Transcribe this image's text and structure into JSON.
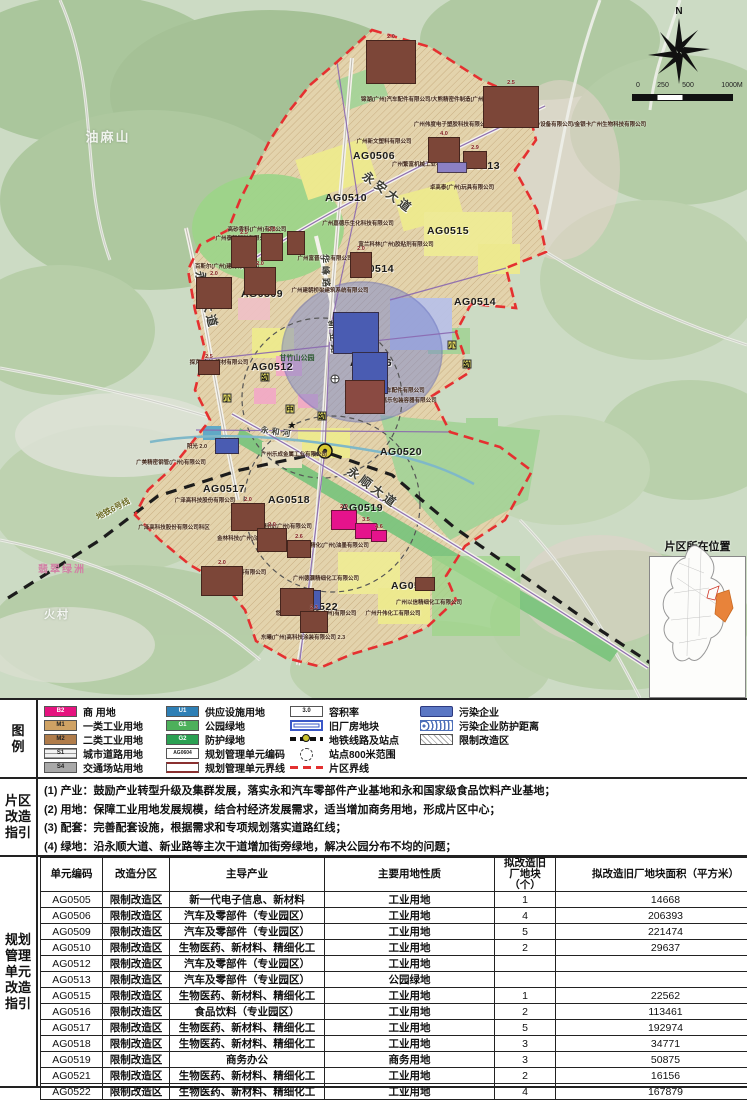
{
  "map": {
    "north_label": "N",
    "scale_ticks": [
      {
        "t": "0",
        "x": 6
      },
      {
        "t": "250",
        "x": 31
      },
      {
        "t": "500",
        "x": 56
      },
      {
        "t": "1000M",
        "x": 100
      }
    ],
    "inset_title": "片区所在位置",
    "unit_codes": [
      {
        "text": "AG0506",
        "x": 374,
        "y": 156
      },
      {
        "text": "AG0513",
        "x": 479,
        "y": 166
      },
      {
        "text": "AG0510",
        "x": 346,
        "y": 198
      },
      {
        "text": "AG0515",
        "x": 448,
        "y": 231
      },
      {
        "text": "AG0514",
        "x": 373,
        "y": 269
      },
      {
        "text": "AG0509",
        "x": 262,
        "y": 294
      },
      {
        "text": "AG0514",
        "x": 475,
        "y": 302
      },
      {
        "text": "AG0512",
        "x": 272,
        "y": 367
      },
      {
        "text": "AG0516",
        "x": 371,
        "y": 363
      },
      {
        "text": "AG0520",
        "x": 401,
        "y": 452
      },
      {
        "text": "AG0517",
        "x": 224,
        "y": 489
      },
      {
        "text": "AG0518",
        "x": 289,
        "y": 500
      },
      {
        "text": "AG0519",
        "x": 362,
        "y": 508
      },
      {
        "text": "AG0521",
        "x": 412,
        "y": 586
      },
      {
        "text": "AG0522",
        "x": 317,
        "y": 607
      }
    ],
    "companies": [
      {
        "text": "锦湖(广州)汽车配件有限公司/大熊精密件制造(广州)有限公司",
        "x": 434,
        "y": 99
      },
      {
        "text": "广州伟度电子塑胶科技有限公司/飞格乐思(广州)制冷设备有限公司/金银卡广州生物科技有限公司",
        "x": 530,
        "y": 124
      },
      {
        "text": "广州新文塑料有限公司",
        "x": 384,
        "y": 141
      },
      {
        "text": "广州繁富机械工业有限公司",
        "x": 425,
        "y": 164
      },
      {
        "text": "卓高泰(广州)玩具有限公司",
        "x": 462,
        "y": 187
      },
      {
        "text": "高砂香料(广州)有限公司",
        "x": 257,
        "y": 229
      },
      {
        "text": "广州泰贺塑料有限公司",
        "x": 243,
        "y": 238
      },
      {
        "text": "广州嘉德乐生化科技有限公司",
        "x": 358,
        "y": 223
      },
      {
        "text": "富兰科林(广州)胶粘剂有限公司",
        "x": 396,
        "y": 244
      },
      {
        "text": "百斯尔(广州)建材有限公司",
        "x": 227,
        "y": 266
      },
      {
        "text": "广州富晋兴业有限公司",
        "x": 325,
        "y": 258
      },
      {
        "text": "广州建朝桥梁建筑系统有限公司",
        "x": 330,
        "y": 290
      },
      {
        "text": "探克(广州)建材有限公司",
        "x": 219,
        "y": 362
      },
      {
        "text": "2.0 广州世双汽车配件有限公司",
        "x": 387,
        "y": 390
      },
      {
        "text": "5.0 广州嘉乐包装容器有限公司",
        "x": 399,
        "y": 400
      },
      {
        "text": "广州乐成金属工业有限公司",
        "x": 294,
        "y": 454
      },
      {
        "text": "广美精密钢管(广州)有限公司",
        "x": 171,
        "y": 462
      },
      {
        "text": "广泽高科技股份有限公司",
        "x": 205,
        "y": 500
      },
      {
        "text": "广泽高科技股份有限公司科区",
        "x": 174,
        "y": 527
      },
      {
        "text": "德高涂料科技(广州)有限公司",
        "x": 277,
        "y": 526
      },
      {
        "text": "金林科技(广州)油墨有限公司",
        "x": 252,
        "y": 538
      },
      {
        "text": "大日精化(广州)油墨有限公司",
        "x": 334,
        "y": 545
      },
      {
        "text": "广州确立尔涂料有限公司",
        "x": 236,
        "y": 572
      },
      {
        "text": "广州德灏精细化工有限公司",
        "x": 326,
        "y": 578
      },
      {
        "text": "广州以信精细化工有限公司",
        "x": 429,
        "y": 602
      },
      {
        "text": "悠育精细化工制造(广州)有限公司",
        "x": 316,
        "y": 613
      },
      {
        "text": "广州升伟化工有限公司",
        "x": 393,
        "y": 613
      },
      {
        "text": "东曦(广州)高科技涂装有限公司 2.3",
        "x": 303,
        "y": 637
      },
      {
        "text": "阳光 2.0",
        "x": 197,
        "y": 446
      }
    ],
    "roads": [
      {
        "text": "永安大道",
        "x": 388,
        "y": 192,
        "rot": 37,
        "size": 12
      },
      {
        "text": "永和大道",
        "x": 207,
        "y": 300,
        "rot": 76,
        "size": 12
      },
      {
        "text": "华峰路",
        "x": 326,
        "y": 272,
        "rot": 87,
        "size": 9
      },
      {
        "text": "新业路",
        "x": 334,
        "y": 338,
        "rot": 84,
        "size": 9
      },
      {
        "text": "永顺大道",
        "x": 373,
        "y": 487,
        "rot": 37,
        "size": 12
      },
      {
        "text": "永和河",
        "x": 277,
        "y": 432,
        "rot": 8,
        "size": 8
      }
    ],
    "metro_label": {
      "text": "地铁6号线",
      "x": 113,
      "y": 509,
      "rot": -28
    },
    "places": [
      {
        "text": "油麻山",
        "x": 108,
        "y": 136,
        "size": 13,
        "cls": ""
      },
      {
        "text": "火村",
        "x": 57,
        "y": 614,
        "size": 11,
        "cls": ""
      },
      {
        "text": "翡翠绿洲",
        "x": 62,
        "y": 568,
        "size": 10,
        "cls": "lab-pink"
      }
    ],
    "poi": [
      {
        "text": "甘竹山公园",
        "x": 297,
        "y": 358
      }
    ],
    "blocks": [
      {
        "x": 366,
        "y": 40,
        "w": 50,
        "h": 44,
        "far": "2.0",
        "c": "#7c4638"
      },
      {
        "x": 483,
        "y": 86,
        "w": 56,
        "h": 42,
        "far": "2.5",
        "c": "#7c4638"
      },
      {
        "x": 428,
        "y": 137,
        "w": 32,
        "h": 26,
        "far": "4.0",
        "c": "#7c4638"
      },
      {
        "x": 463,
        "y": 151,
        "w": 24,
        "h": 18,
        "far": "2.9",
        "c": "#7c4638"
      },
      {
        "x": 437,
        "y": 162,
        "w": 30,
        "h": 11,
        "far": "",
        "c": "#8b80c4"
      },
      {
        "x": 231,
        "y": 236,
        "w": 26,
        "h": 32,
        "far": "2.5",
        "c": "#7c4638"
      },
      {
        "x": 261,
        "y": 233,
        "w": 22,
        "h": 28,
        "far": "2.5",
        "c": "#7c4638"
      },
      {
        "x": 287,
        "y": 231,
        "w": 18,
        "h": 24,
        "far": "",
        "c": "#7c4638"
      },
      {
        "x": 244,
        "y": 267,
        "w": 32,
        "h": 28,
        "far": "2.0",
        "c": "#7c4638"
      },
      {
        "x": 196,
        "y": 277,
        "w": 36,
        "h": 32,
        "far": "2.0",
        "c": "#7c4638"
      },
      {
        "x": 350,
        "y": 252,
        "w": 22,
        "h": 26,
        "far": "2.0",
        "c": "#7c4638"
      },
      {
        "x": 198,
        "y": 360,
        "w": 22,
        "h": 15,
        "far": "2.5",
        "c": "#7c4638"
      },
      {
        "x": 333,
        "y": 312,
        "w": 46,
        "h": 42,
        "far": "",
        "c": "#4a5cb2"
      },
      {
        "x": 352,
        "y": 352,
        "w": 36,
        "h": 42,
        "far": "",
        "c": "#4a5cb2"
      },
      {
        "x": 345,
        "y": 380,
        "w": 40,
        "h": 34,
        "far": "",
        "c": "#8a4a42"
      },
      {
        "x": 215,
        "y": 438,
        "w": 24,
        "h": 16,
        "far": "",
        "c": "#4a5cb2"
      },
      {
        "x": 299,
        "y": 590,
        "w": 22,
        "h": 20,
        "far": "",
        "c": "#4a5cb2"
      },
      {
        "x": 231,
        "y": 503,
        "w": 34,
        "h": 28,
        "far": "2.0",
        "c": "#7c4638"
      },
      {
        "x": 257,
        "y": 528,
        "w": 30,
        "h": 24,
        "far": "2.0",
        "c": "#7c4638"
      },
      {
        "x": 287,
        "y": 540,
        "w": 24,
        "h": 18,
        "far": "2.6",
        "c": "#7c4638"
      },
      {
        "x": 201,
        "y": 566,
        "w": 42,
        "h": 30,
        "far": "2.0",
        "c": "#7c4638"
      },
      {
        "x": 280,
        "y": 588,
        "w": 34,
        "h": 28,
        "far": "",
        "c": "#7c4638"
      },
      {
        "x": 300,
        "y": 611,
        "w": 28,
        "h": 22,
        "far": "2.3",
        "c": "#7c4638"
      },
      {
        "x": 415,
        "y": 577,
        "w": 20,
        "h": 14,
        "far": "",
        "c": "#7c4638"
      },
      {
        "x": 331,
        "y": 510,
        "w": 26,
        "h": 20,
        "far": "2.0",
        "c": "#e5138c"
      },
      {
        "x": 355,
        "y": 523,
        "w": 22,
        "h": 16,
        "far": "3.5",
        "c": "#e5138c"
      },
      {
        "x": 371,
        "y": 530,
        "w": 16,
        "h": 12,
        "far": "4.6",
        "c": "#e5138c"
      }
    ],
    "facilities": [
      {
        "g": "幼",
        "x": 265,
        "y": 377,
        "cls": ""
      },
      {
        "g": "小",
        "x": 227,
        "y": 398,
        "cls": ""
      },
      {
        "g": "中",
        "x": 290,
        "y": 409,
        "cls": ""
      },
      {
        "g": "幼",
        "x": 322,
        "y": 416,
        "cls": ""
      },
      {
        "g": "★",
        "x": 292,
        "y": 426,
        "cls": "star"
      },
      {
        "g": "十",
        "x": 335,
        "y": 379,
        "cls": "round"
      },
      {
        "g": "小",
        "x": 452,
        "y": 345,
        "cls": ""
      },
      {
        "g": "幼",
        "x": 467,
        "y": 364,
        "cls": ""
      }
    ]
  },
  "legend": {
    "side_label": [
      "图",
      "例"
    ],
    "col1": [
      {
        "type": "code",
        "code": "B2",
        "color": "#e5137f",
        "dark": false,
        "label": "商  用地"
      },
      {
        "type": "code",
        "code": "M1",
        "color": "#cfa264",
        "dark": true,
        "label": "一类工业用地"
      },
      {
        "type": "code",
        "code": "M2",
        "color": "#b07c4a",
        "dark": true,
        "label": "二类工业用地"
      },
      {
        "type": "code",
        "code": "S1",
        "color": "#f2f2f2",
        "dark": true,
        "striped": true,
        "label": "城市道路用地"
      },
      {
        "type": "code",
        "code": "S4",
        "color": "#a9a9a9",
        "dark": true,
        "label": "交通场站用地"
      }
    ],
    "col2": [
      {
        "type": "code",
        "code": "U1",
        "color": "#2e7fb5",
        "dark": false,
        "label": "供应设施用地"
      },
      {
        "type": "code",
        "code": "G1",
        "color": "#4db05b",
        "dark": false,
        "label": "公园绿地"
      },
      {
        "type": "code",
        "code": "G2",
        "color": "#2aa052",
        "dark": false,
        "label": "防护绿地"
      },
      {
        "type": "codebox",
        "code": "AG0604",
        "label": "规划管理单元编码"
      },
      {
        "type": "unitline",
        "label": "规划管理单元界线"
      }
    ],
    "col3": [
      {
        "type": "farbox",
        "code": "3.0",
        "label": "容积率"
      },
      {
        "type": "oldplot",
        "label": "旧厂房地块"
      },
      {
        "type": "metro",
        "label": "地铁线路及站点"
      },
      {
        "type": "circledash",
        "label": "站点800米范围"
      },
      {
        "type": "reddash",
        "label": "片区界线"
      }
    ],
    "col4": [
      {
        "type": "bluebar",
        "label": "污染企业"
      },
      {
        "type": "bluehatch",
        "label": "污染企业防护距离"
      },
      {
        "type": "hatchbox",
        "label": "限制改造区"
      }
    ]
  },
  "guideline": {
    "side_label": [
      "片区",
      "改造",
      "指引"
    ],
    "lines": [
      "(1) 产业：鼓励产业转型升级及集群发展，落实永和汽车零部件产业基地和永和国家级食品饮料产业基地；",
      "(2) 用地：保障工业用地发展规模，结合村经济发展需求，适当增加商务用地，形成片区中心；",
      "(3) 配套：完善配套设施，根据需求和专项规划落实道路红线；",
      "(4) 绿地：沿永顺大道、新业路等主次干道增加街旁绿地，解决公园分布不均的问题；"
    ]
  },
  "unit_table": {
    "side_label": [
      "规划",
      "管理",
      "单元",
      "改造",
      "指引"
    ],
    "headers": [
      "单元编码",
      "改造分区",
      "主导产业",
      "主要用地性质",
      "拟改造旧\n厂地块\n（个）",
      "拟改造旧厂地块面积（平方米）"
    ],
    "col_widths": [
      57,
      62,
      150,
      165,
      56,
      215
    ],
    "rows": [
      [
        "AG0505",
        "限制改造区",
        "新一代电子信息、新材料",
        "工业用地",
        "1",
        "14668"
      ],
      [
        "AG0506",
        "限制改造区",
        "汽车及零部件（专业园区）",
        "工业用地",
        "4",
        "206393"
      ],
      [
        "AG0509",
        "限制改造区",
        "汽车及零部件（专业园区）",
        "工业用地",
        "5",
        "221474"
      ],
      [
        "AG0510",
        "限制改造区",
        "生物医药、新材料、精细化工",
        "工业用地",
        "2",
        "29637"
      ],
      [
        "AG0512",
        "限制改造区",
        "汽车及零部件（专业园区）",
        "工业用地",
        "",
        ""
      ],
      [
        "AG0513",
        "限制改造区",
        "汽车及零部件（专业园区）",
        "公园绿地",
        "",
        ""
      ],
      [
        "AG0515",
        "限制改造区",
        "生物医药、新材料、精细化工",
        "工业用地",
        "1",
        "22562"
      ],
      [
        "AG0516",
        "限制改造区",
        "食品饮料（专业园区）",
        "工业用地",
        "2",
        "113461"
      ],
      [
        "AG0517",
        "限制改造区",
        "生物医药、新材料、精细化工",
        "工业用地",
        "5",
        "192974"
      ],
      [
        "AG0518",
        "限制改造区",
        "生物医药、新材料、精细化工",
        "工业用地",
        "3",
        "34771"
      ],
      [
        "AG0519",
        "限制改造区",
        "商务办公",
        "商务用地",
        "3",
        "50875"
      ],
      [
        "AG0521",
        "限制改造区",
        "生物医药、新材料、精细化工",
        "工业用地",
        "2",
        "16156"
      ],
      [
        "AG0522",
        "限制改造区",
        "生物医药、新材料、精细化工",
        "工业用地",
        "4",
        "167879"
      ]
    ]
  },
  "colors": {
    "boundary_red": "#e53030",
    "metro_black": "#1c1c1c",
    "unit_line_purple": "#8a68b0"
  }
}
